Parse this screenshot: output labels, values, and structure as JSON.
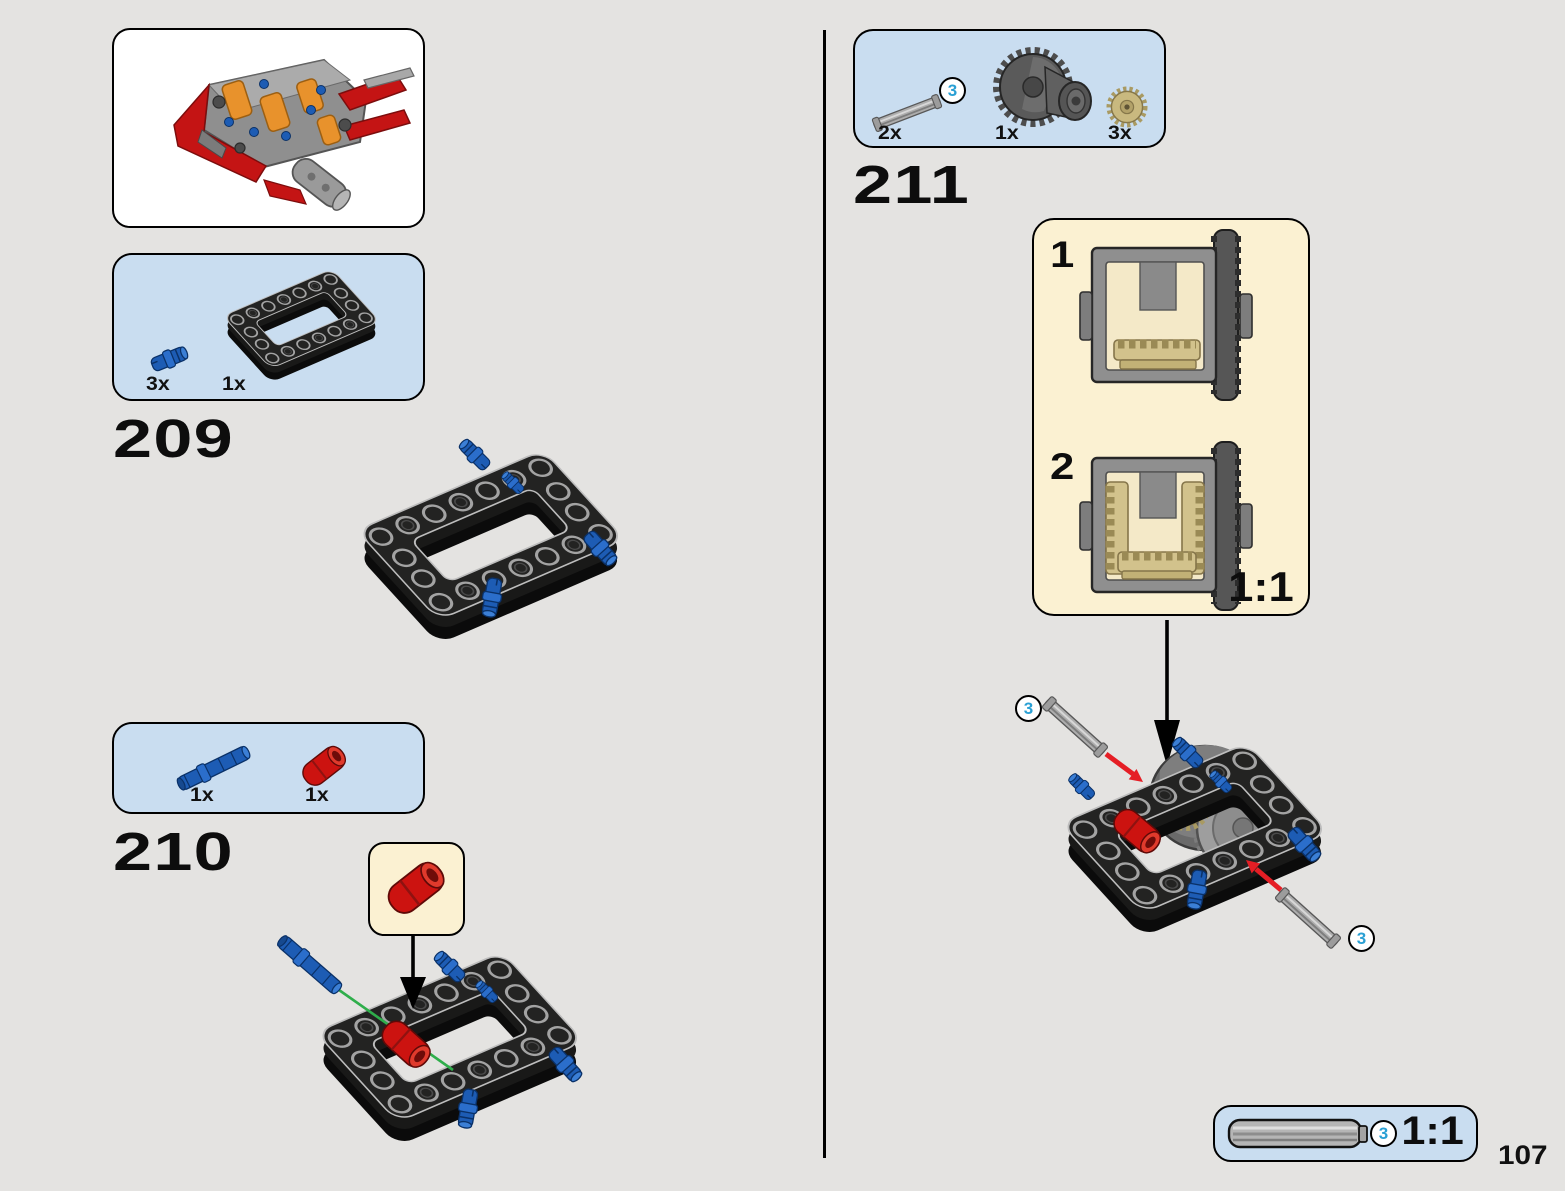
{
  "page": {
    "number": "107"
  },
  "steps": {
    "s209": {
      "number": "209",
      "pin_qty": "3x",
      "frame_qty": "1x"
    },
    "s210": {
      "number": "210",
      "longpin_qty": "1x",
      "tube_qty": "1x"
    },
    "s211": {
      "number": "211",
      "axle_qty": "2x",
      "axle_badge": "3",
      "diff_qty": "1x",
      "gear_qty": "3x",
      "substep1": "1",
      "substep2": "2",
      "scale": "1:1",
      "badge_top": "3",
      "badge_bottom": "3"
    }
  },
  "footer": {
    "badge": "3",
    "scale": "1:1"
  }
}
